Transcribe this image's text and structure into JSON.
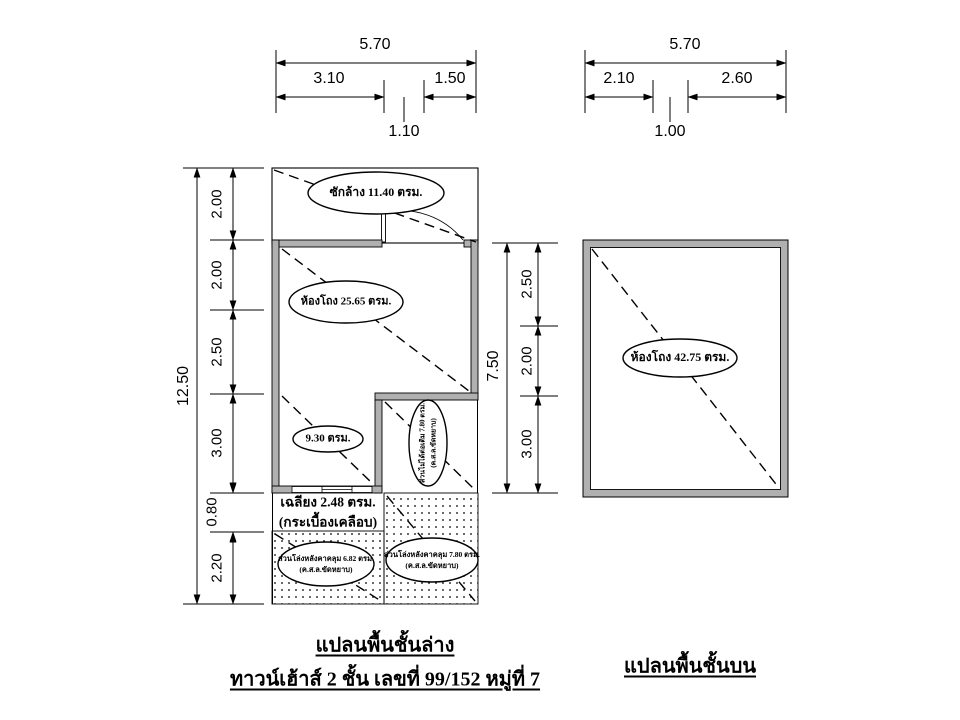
{
  "ground_plan": {
    "caption": "แปลนพื้นชั้นล่าง",
    "subcaption": "ทาวน์เฮ้าส์ 2 ชั้น เลขที่ 99/152 หมู่ที่ 7",
    "labels": {
      "laundry": "ซักล้าง 11.40 ตรม.",
      "hall": "ห้องโถง 25.65  ตรม.",
      "room_930": "9.30 ตรม.",
      "unroofed_line1": "ส่วนไม่ได้ต่อเติม 7.80 ตรม.",
      "unroofed_line2": "(ค.ส.ล.ขัดหยาบ)",
      "porch_line1": "เฉลียง 2.48 ตรม.",
      "porch_line2": "(กระเบื้องเคลือบ)",
      "open_left_line1": "ส่วนโล่งหลังคาคลุม 6.82 ตรม.",
      "open_left_line2": "(ค.ส.ล.ขัดหยาบ)",
      "open_right_line1": "ส่วนโล่งหลังคาคลุม 7.80 ตรม.",
      "open_right_line2": "(ค.ส.ล.ขัดหยาบ)"
    },
    "dims": {
      "width_total": "5.70",
      "width_left": "3.10",
      "width_mid": "1.10",
      "width_right": "1.50",
      "height_total": "12.50",
      "height_segments": [
        "2.00",
        "2.00",
        "2.50",
        "3.00",
        "0.80",
        "2.20"
      ],
      "inner_height_total": "7.50",
      "inner_height_segments": [
        "2.50",
        "2.00",
        "3.00"
      ]
    }
  },
  "upper_plan": {
    "caption": "แปลนพื้นชั้นบน",
    "labels": {
      "hall": "ห้องโถง 42.75  ตรม."
    },
    "dims": {
      "width_total": "5.70",
      "width_left": "2.10",
      "width_mid": "1.00",
      "width_right": "2.60"
    }
  },
  "colors": {
    "wall_fill": "#b0b0b0",
    "line": "#000000",
    "paper": "#ffffff"
  }
}
